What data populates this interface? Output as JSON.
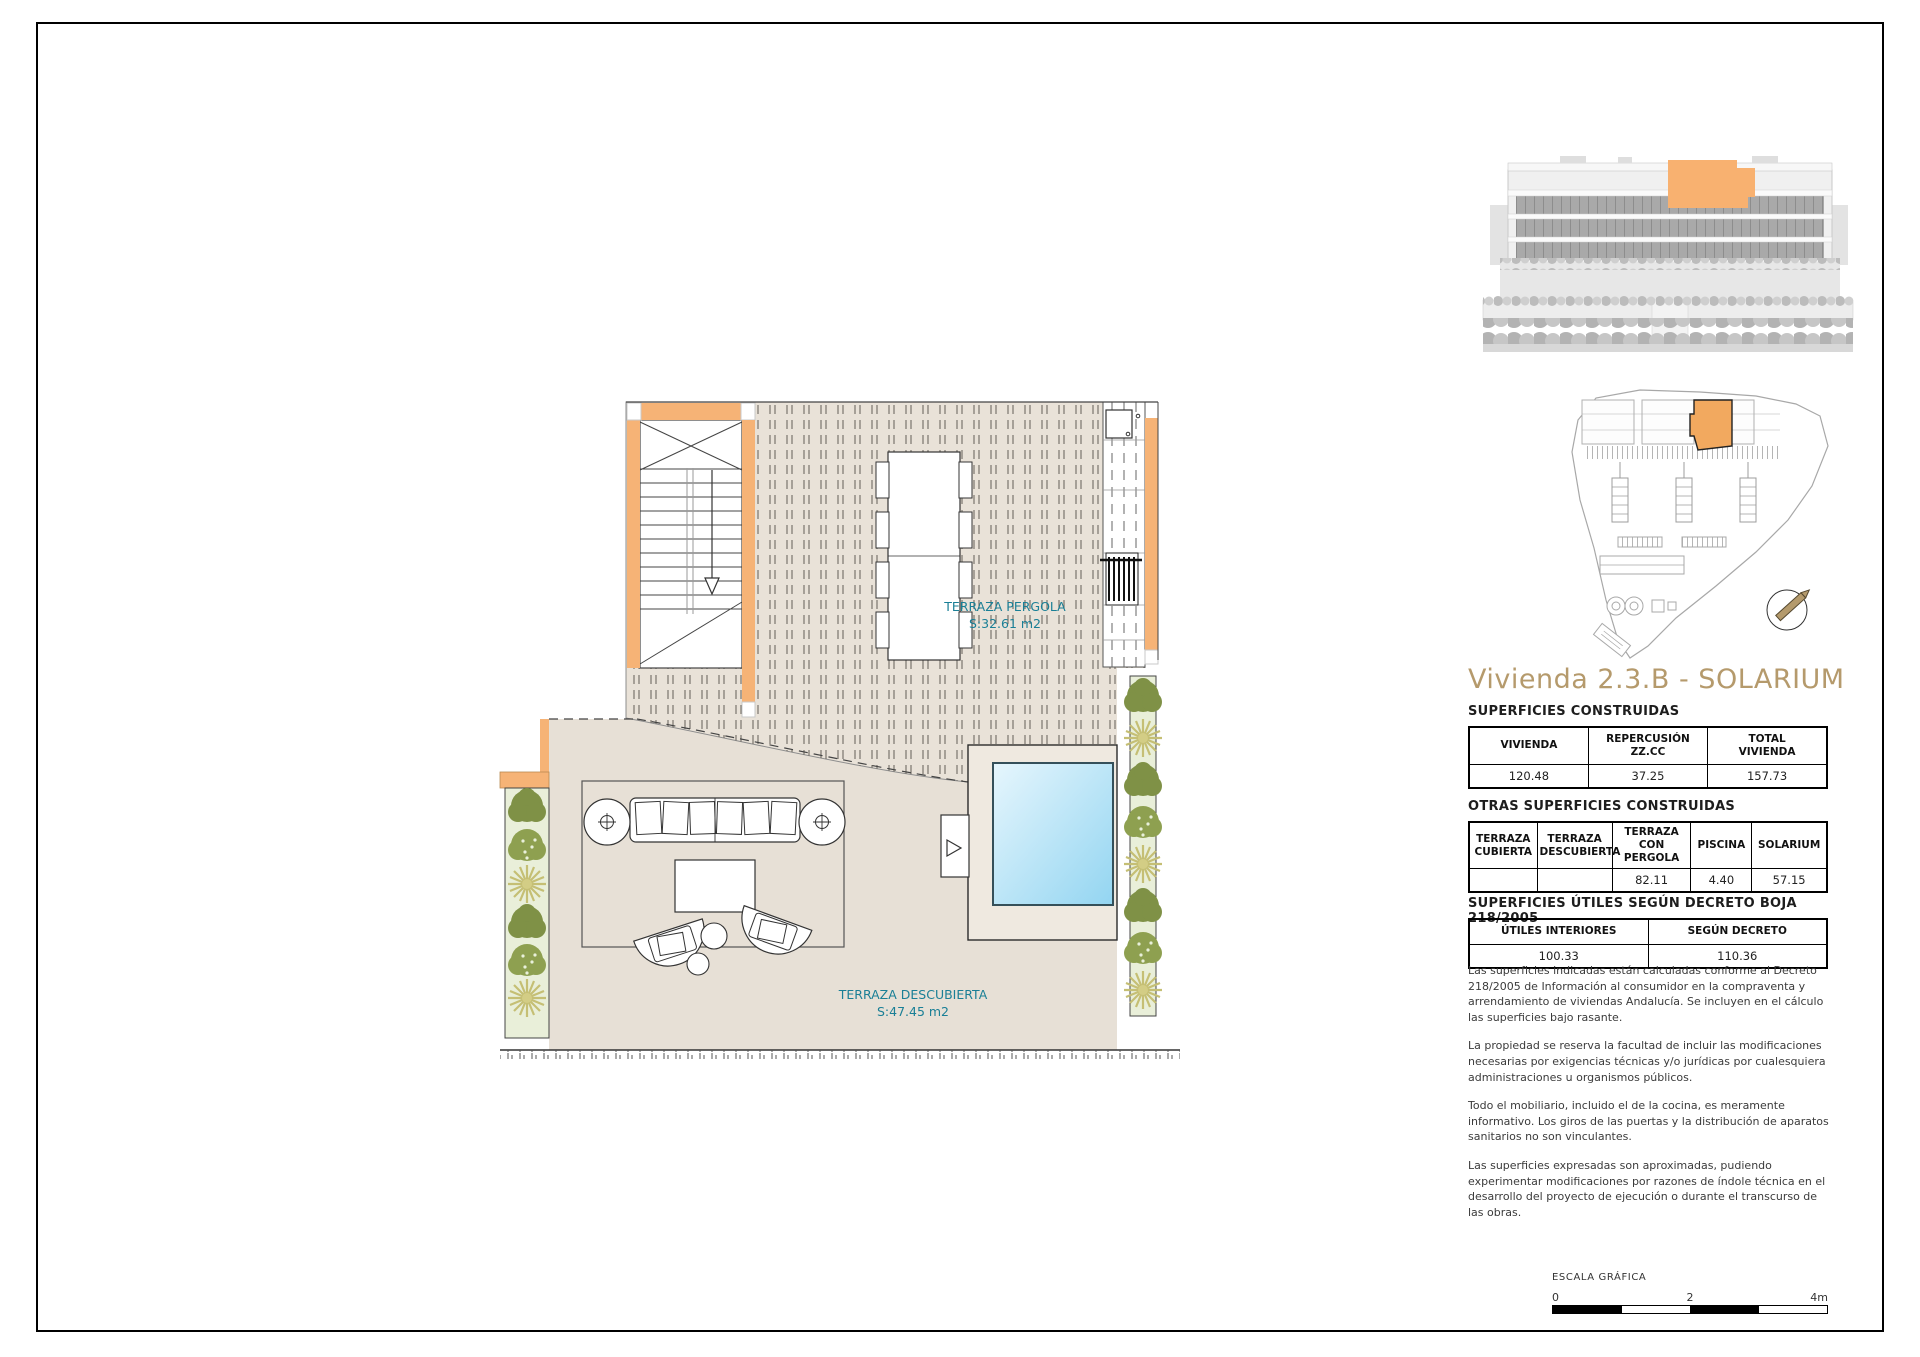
{
  "title": "Vivienda 2.3.B - SOLARIUM",
  "plan_labels": {
    "pergola": {
      "name": "TERRAZA PERGOLA",
      "area": "S:32.61 m2"
    },
    "descubierta": {
      "name": "TERRAZA DESCUBIERTA",
      "area": "S:47.45 m2"
    }
  },
  "tables": {
    "construidas": {
      "heading": "SUPERFICIES CONSTRUIDAS",
      "columns": [
        "VIVIENDA",
        "REPERCUSIÓN\nZZ.CC",
        "TOTAL\nVIVIENDA"
      ],
      "values": [
        "120.48",
        "37.25",
        "157.73"
      ]
    },
    "otras": {
      "heading": "OTRAS SUPERFICIES CONSTRUIDAS",
      "columns": [
        "TERRAZA\nCUBIERTA",
        "TERRAZA\nDESCUBIERTA",
        "TERRAZA\nCON PERGOLA",
        "PISCINA",
        "SOLARIUM"
      ],
      "values": [
        "",
        "",
        "82.11",
        "4.40",
        "57.15"
      ]
    },
    "utiles": {
      "heading": "SUPERFICIES ÚTILES SEGÚN DECRETO BOJA 218/2005",
      "columns": [
        "ÚTILES INTERIORES",
        "SEGÚN DECRETO"
      ],
      "values": [
        "100.33",
        "110.36"
      ]
    }
  },
  "notes": [
    "Las superficies indicadas están calculadas conforme al Decreto 218/2005 de Información al consumidor en la compraventa y arrendamiento de viviendas Andalucía. Se incluyen en el cálculo las superficies bajo rasante.",
    "La propiedad se reserva la facultad de incluir las modificaciones necesarias por exigencias técnicas y/o jurídicas por cualesquiera administraciones u organismos públicos.",
    "Todo el mobiliario, incluido el de la cocina, es meramente informativo. Los giros de las puertas y la distribución de aparatos sanitarios no son vinculantes.",
    "Las superficies expresadas son aproximadas, pudiendo experimentar modificaciones por razones de índole técnica en el desarrollo del proyecto de ejecución o durante el transcurso de las obras."
  ],
  "scale_bar": {
    "label": "ESCALA GRÁFICA",
    "tick_start": "0",
    "tick_mid": "2",
    "tick_end": "4m"
  },
  "colors": {
    "accent_title": "#b59a6c",
    "highlight_orange": "#f6b376",
    "label_teal": "#1a7f96",
    "pool_blue": "#a5dcf2"
  }
}
